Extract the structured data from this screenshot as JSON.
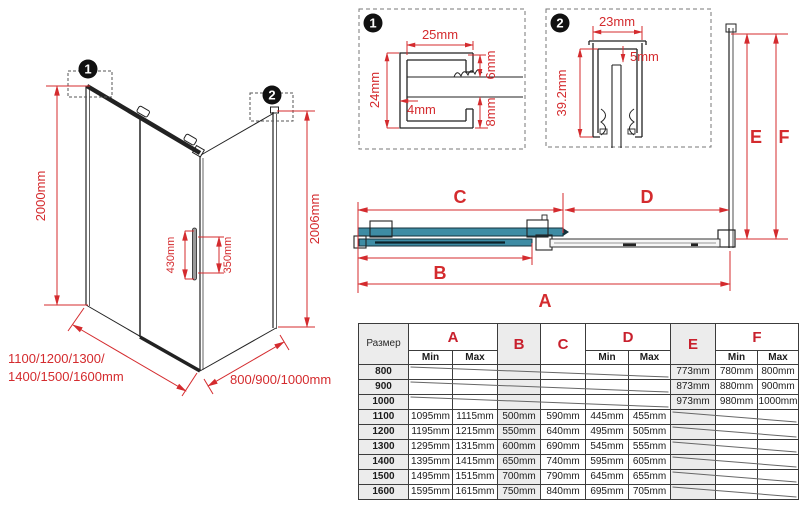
{
  "iso": {
    "badge1": "1",
    "badge2": "2",
    "dim_height_left": "2000mm",
    "dim_height_right": "2006mm",
    "dim_handle_length": "430mm",
    "dim_handle_holes": "350mm",
    "dim_front_widths_line1": "1100/1200/1300/",
    "dim_front_widths_line2": "1400/1500/1600mm",
    "dim_side_widths": "800/900/1000mm"
  },
  "detail1": {
    "badge": "1",
    "dim_top": "25mm",
    "dim_left": "24mm",
    "dim_inner": "4mm",
    "dim_right_top": "6mm",
    "dim_right_bottom": "8mm"
  },
  "detail2": {
    "badge": "2",
    "dim_top": "23mm",
    "dim_gap": "5mm",
    "dim_left": "39.2mm"
  },
  "plan": {
    "label_a": "A",
    "label_b": "B",
    "label_c": "C",
    "label_d": "D",
    "label_e": "E",
    "label_f": "F"
  },
  "table": {
    "header": {
      "size": "Размер",
      "A": "A",
      "B": "B",
      "C": "C",
      "D": "D",
      "E": "E",
      "F": "F",
      "min": "Min",
      "max": "Max"
    },
    "rows": [
      {
        "size": "800",
        "cells": [
          "",
          "",
          "",
          "",
          "",
          "",
          "773mm",
          "780mm",
          "800mm"
        ]
      },
      {
        "size": "900",
        "cells": [
          "",
          "",
          "",
          "",
          "",
          "",
          "873mm",
          "880mm",
          "900mm"
        ]
      },
      {
        "size": "1000",
        "cells": [
          "",
          "",
          "",
          "",
          "",
          "",
          "973mm",
          "980mm",
          "1000mm"
        ]
      },
      {
        "size": "1100",
        "cells": [
          "1095mm",
          "1115mm",
          "500mm",
          "590mm",
          "445mm",
          "455mm",
          "",
          "",
          ""
        ]
      },
      {
        "size": "1200",
        "cells": [
          "1195mm",
          "1215mm",
          "550mm",
          "640mm",
          "495mm",
          "505mm",
          "",
          "",
          ""
        ]
      },
      {
        "size": "1300",
        "cells": [
          "1295mm",
          "1315mm",
          "600mm",
          "690mm",
          "545mm",
          "555mm",
          "",
          "",
          ""
        ]
      },
      {
        "size": "1400",
        "cells": [
          "1395mm",
          "1415mm",
          "650mm",
          "740mm",
          "595mm",
          "605mm",
          "",
          "",
          ""
        ]
      },
      {
        "size": "1500",
        "cells": [
          "1495mm",
          "1515mm",
          "700mm",
          "790mm",
          "645mm",
          "655mm",
          "",
          "",
          ""
        ]
      },
      {
        "size": "1600",
        "cells": [
          "1595mm",
          "1615mm",
          "750mm",
          "840mm",
          "695mm",
          "705mm",
          "",
          "",
          ""
        ]
      }
    ]
  },
  "colors": {
    "dimension_red": "#d42b2e",
    "glass_teal": "#3e8ca4",
    "line_black": "#222222",
    "cell_shade": "#ececec"
  }
}
